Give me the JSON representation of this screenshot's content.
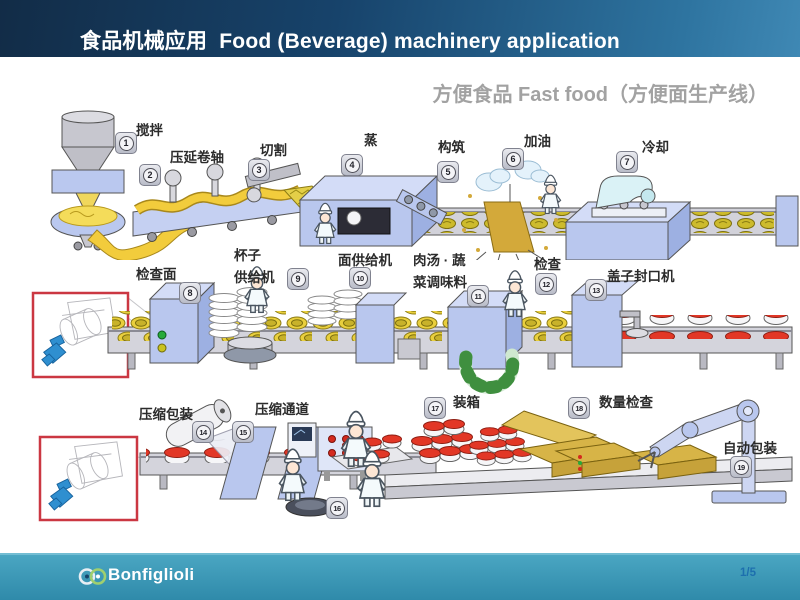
{
  "header": {
    "title": "食品机械应用  Food (Beverage) machinery application"
  },
  "subtitle": "方便食品 Fast food（方便面生产线）",
  "stations": [
    {
      "num": "1",
      "label": "搅拌"
    },
    {
      "num": "2",
      "label": "压延卷轴"
    },
    {
      "num": "3",
      "label": "切割"
    },
    {
      "num": "4",
      "label": "蒸"
    },
    {
      "num": "5",
      "label": "构筑"
    },
    {
      "num": "6",
      "label": "加油"
    },
    {
      "num": "7",
      "label": "冷却"
    },
    {
      "num": "8",
      "label": "检查面"
    },
    {
      "num": "9",
      "label": "杯子供给机",
      "label_line1": "杯子",
      "label_line2": "供给机"
    },
    {
      "num": "10",
      "label": "面供给机"
    },
    {
      "num": "11",
      "label": "肉汤·蔬菜调味料",
      "label_line1": "肉汤 · 蔬",
      "label_line2": "菜调味料"
    },
    {
      "num": "12",
      "label": "检查"
    },
    {
      "num": "13",
      "label": "盖子封口机"
    },
    {
      "num": "14",
      "label": "压缩包装"
    },
    {
      "num": "15",
      "label": "压缩通道"
    },
    {
      "num": "16",
      "label": ""
    },
    {
      "num": "17",
      "label": "装箱"
    },
    {
      "num": "18",
      "label": "数量检查"
    },
    {
      "num": "19",
      "label": "自动包装"
    }
  ],
  "footer": {
    "brand": "Bonfiglioli",
    "page": "1/5"
  },
  "colors": {
    "header_dark_blue": "#122c47",
    "header_light_blue": "#3f88b4",
    "subtitle_gray": "#a2a2a2",
    "footer_teal": "#2f8aaa",
    "page_number_blue": "#1d6fae",
    "machine_periwinkle": "#b9c7ee",
    "conveyor_gray": "#d4d4dc",
    "noodle_yellow": "#e9cf3d",
    "lid_red": "#e23726",
    "box_tan": "#d7b447",
    "inset_border_red": "#cb3742",
    "gearmotor_blue": "#2f8fd0",
    "badge_gray": "#c4c7d1"
  }
}
